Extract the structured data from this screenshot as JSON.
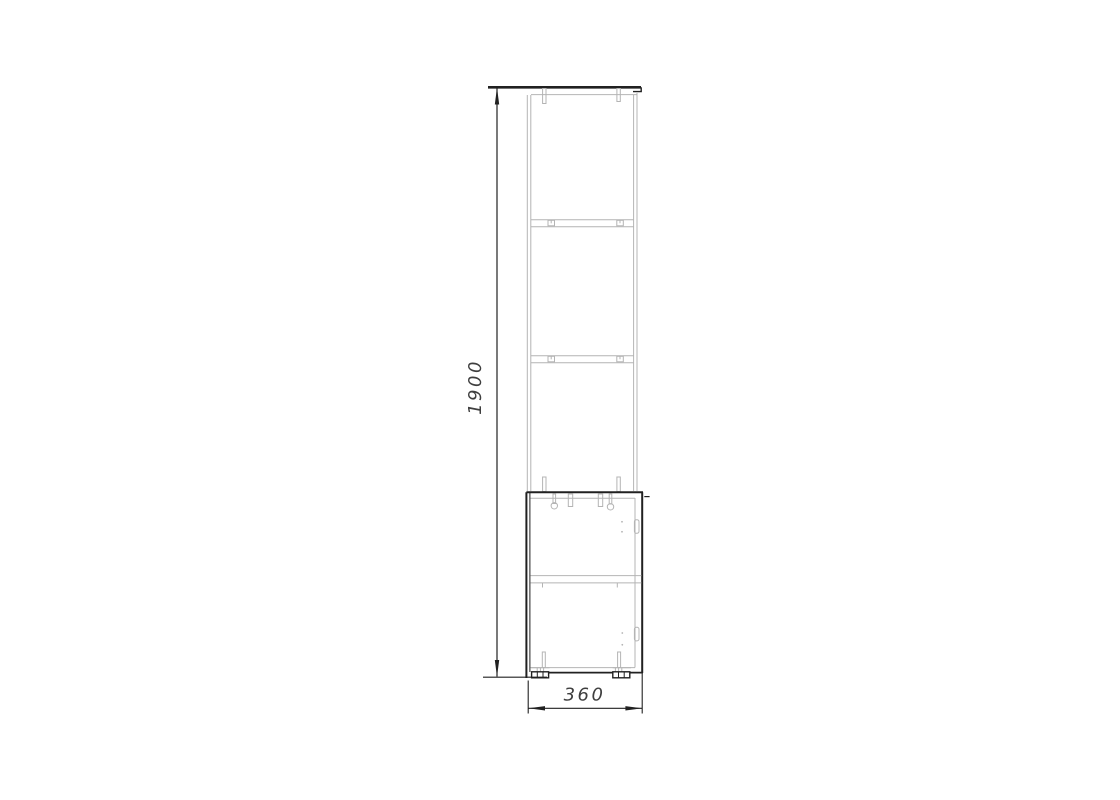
{
  "drawing": {
    "type": "furniture-side-elevation",
    "height_dimension": {
      "label": "1900",
      "unit_hint": "mm"
    },
    "width_dimension": {
      "label": "360",
      "unit_hint": "mm"
    },
    "colors": {
      "outline_dark": "#212121",
      "outline_light": "#b4b4b4",
      "dimension_text": "#3f3f3f",
      "page_bg": "#ffffff"
    }
  }
}
